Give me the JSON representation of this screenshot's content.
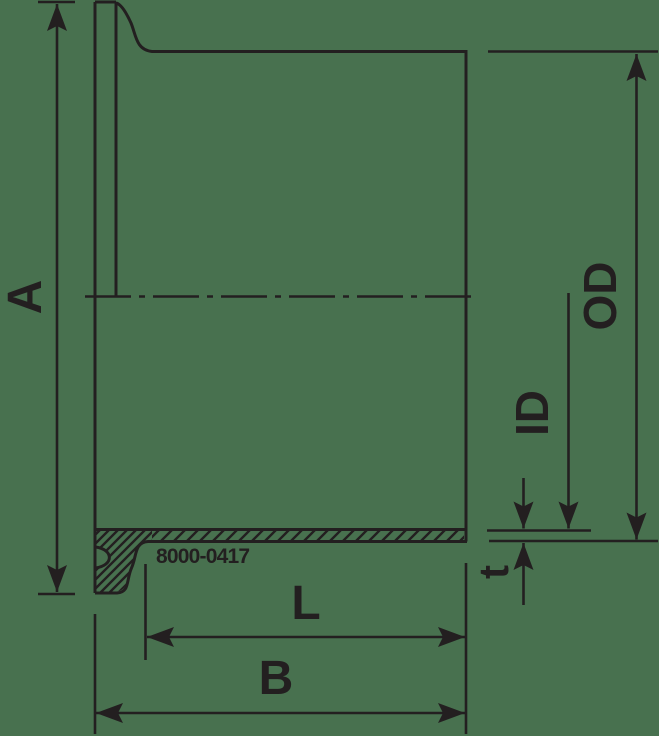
{
  "drawing": {
    "title": "Clamp ferrule dimension drawing",
    "part_number": "8000-0417",
    "labels": {
      "overall_height": "A",
      "outer_diameter": "OD",
      "inner_diameter": "ID",
      "wall_thickness": "t",
      "tangent_length": "L",
      "overall_length": "B"
    },
    "colors": {
      "background": "#48714f",
      "line": "#231f20"
    }
  }
}
